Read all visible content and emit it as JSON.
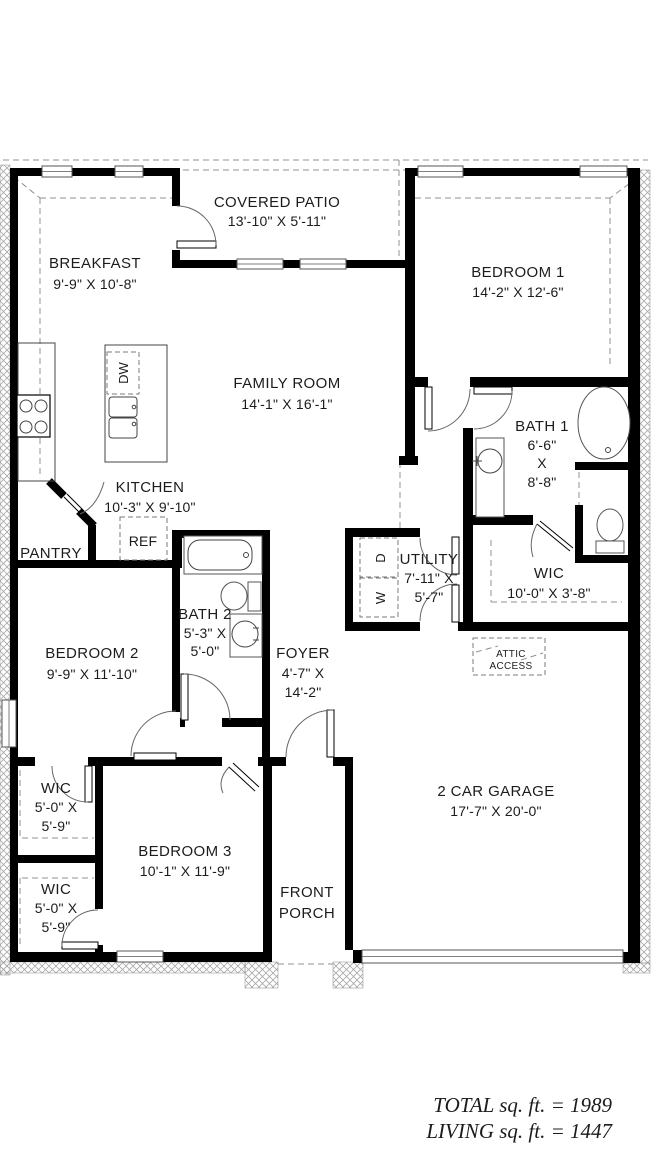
{
  "plan": {
    "rooms": {
      "covered_patio": {
        "name": "COVERED PATIO",
        "dims": "13'-10\" X 5'-11\""
      },
      "breakfast": {
        "name": "BREAKFAST",
        "dims": "9'-9\" X 10'-8\""
      },
      "bedroom1": {
        "name": "BEDROOM 1",
        "dims": "14'-2\" X 12'-6\""
      },
      "family_room": {
        "name": "FAMILY ROOM",
        "dims": "14'-1\" X 16'-1\""
      },
      "bath1": {
        "name": "BATH 1",
        "dim_w": "6'-6\"",
        "dim_sep": "X",
        "dim_h": "8'-8\""
      },
      "kitchen": {
        "name": "KITCHEN",
        "dims": "10'-3\" X 9'-10\""
      },
      "pantry": {
        "name": "PANTRY"
      },
      "utility": {
        "name": "UTILITY",
        "dim_w": "7'-11\" X",
        "dim_h": "5'-7\""
      },
      "wic_master": {
        "name": "WIC",
        "dims": "10'-0\" X 3'-8\""
      },
      "bath2": {
        "name": "BATH 2",
        "dim_w": "5'-3\" X",
        "dim_h": "5'-0\""
      },
      "bedroom2": {
        "name": "BEDROOM 2",
        "dims": "9'-9\" X 11'-10\""
      },
      "foyer": {
        "name": "FOYER",
        "dim_w": "4'-7\" X",
        "dim_h": "14'-2\""
      },
      "wic_bed2": {
        "name": "WIC",
        "dim_w": "5'-0\" X",
        "dim_h": "5'-9\""
      },
      "bedroom3": {
        "name": "BEDROOM 3",
        "dims": "10'-1\" X 11'-9\""
      },
      "wic_bed3": {
        "name": "WIC",
        "dim_w": "5'-0\" X",
        "dim_h": "5'-9\""
      },
      "garage": {
        "name": "2 CAR GARAGE",
        "dims": "17'-7\" X 20'-0\""
      },
      "front_porch": {
        "line1": "FRONT",
        "line2": "PORCH"
      }
    },
    "annotations": {
      "attic_access": {
        "line1": "ATTIC",
        "line2": "ACCESS"
      },
      "refrigerator": "REF",
      "dishwasher": "DW",
      "dryer": "D",
      "washer": "W"
    },
    "totals": {
      "total": "TOTAL sq. ft. = 1989",
      "living": "LIVING sq. ft. = 1447"
    },
    "colors": {
      "wall": "#000000",
      "dash": "#909090",
      "text": "#1c1c1c",
      "background": "#ffffff"
    }
  }
}
